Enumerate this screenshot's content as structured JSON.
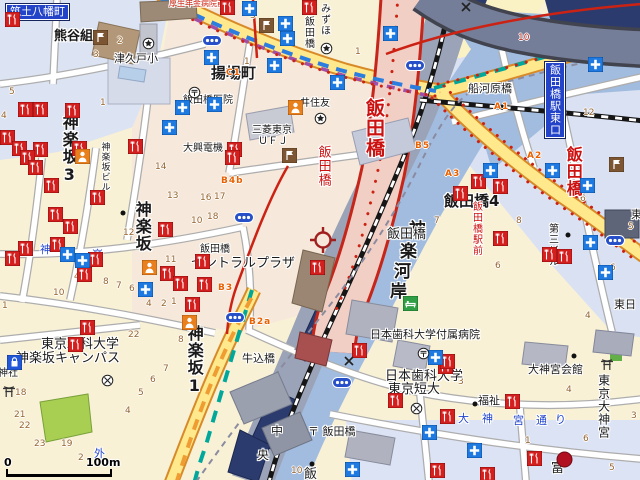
{
  "map": {
    "scale_bar": {
      "start": "0",
      "end": "100m"
    },
    "center_marker": {
      "x": 323,
      "y": 240
    },
    "palette": {
      "water": "#a2bcdf",
      "road_major": "#ffe98c",
      "road_trunk": "#f2cfc5",
      "trunk_border": "#c6251a",
      "rail_corridor": "#9aa3b7",
      "expressway": "#757e98",
      "metro_tozai": "#2b7de0",
      "metro_namboku": "#00a79b",
      "metro_yurakucho": "#ef9d32",
      "metro_oedo": "#a04fa8",
      "exit_text": "#e86000",
      "block_number": "#96642f"
    },
    "labels": [
      {
        "t": "筑土八幡町",
        "x": 6,
        "y": 4,
        "s": 11,
        "o": "h",
        "style": "plate"
      },
      {
        "t": "熊谷組",
        "x": 54,
        "y": 30,
        "s": 13,
        "o": "h",
        "b": 1
      },
      {
        "t": "津久戸小",
        "x": 114,
        "y": 53,
        "s": 11,
        "o": "h"
      },
      {
        "t": "厚生年金病院前",
        "x": 169,
        "y": 0,
        "s": 8,
        "o": "h",
        "c": "#cc2211"
      },
      {
        "t": "みずほ",
        "x": 318,
        "y": 3,
        "s": 10,
        "o": "v"
      },
      {
        "t": "飯田橋",
        "x": 302,
        "y": 16,
        "s": 10,
        "o": "v"
      },
      {
        "t": "揚場町",
        "x": 211,
        "y": 66,
        "s": 15,
        "o": "h",
        "b": 1
      },
      {
        "t": "飯田橋医院",
        "x": 183,
        "y": 96,
        "s": 10,
        "o": "h"
      },
      {
        "t": "井住友",
        "x": 300,
        "y": 99,
        "s": 10,
        "o": "h"
      },
      {
        "t": "三菱東京",
        "x": 252,
        "y": 126,
        "s": 10,
        "o": "h"
      },
      {
        "t": "ＵＦＪ",
        "x": 258,
        "y": 137,
        "s": 10,
        "o": "h"
      },
      {
        "t": "大興電機",
        "x": 183,
        "y": 144,
        "s": 10,
        "o": "h"
      },
      {
        "t": "神楽坂3",
        "x": 60,
        "y": 114,
        "s": 16,
        "o": "v",
        "b": 1
      },
      {
        "t": "神楽坂ビル",
        "x": 99,
        "y": 142,
        "s": 9,
        "o": "v"
      },
      {
        "t": "神楽坂",
        "x": 133,
        "y": 201,
        "s": 16,
        "o": "v",
        "b": 1
      },
      {
        "t": "神",
        "x": 40,
        "y": 244,
        "s": 11,
        "o": "h",
        "c": "#2244cc"
      },
      {
        "t": "楽",
        "x": 92,
        "y": 249,
        "s": 11,
        "o": "h",
        "c": "#2244cc"
      },
      {
        "t": "飯田橋",
        "x": 363,
        "y": 98,
        "s": 19,
        "o": "v",
        "b": 1,
        "c": "#cc1111"
      },
      {
        "t": "飯田橋",
        "x": 316,
        "y": 145,
        "s": 13,
        "o": "v",
        "c": "#cc1111"
      },
      {
        "t": "飯田橋",
        "x": 200,
        "y": 245,
        "s": 10,
        "o": "h"
      },
      {
        "t": "セントラルプラザ",
        "x": 191,
        "y": 257,
        "s": 13,
        "o": "h"
      },
      {
        "t": "神",
        "x": 409,
        "y": 222,
        "s": 17,
        "o": "h",
        "b": 1
      },
      {
        "t": "楽",
        "x": 400,
        "y": 244,
        "s": 17,
        "o": "h",
        "b": 1
      },
      {
        "t": "河",
        "x": 394,
        "y": 264,
        "s": 17,
        "o": "h",
        "b": 1
      },
      {
        "t": "岸",
        "x": 390,
        "y": 284,
        "s": 17,
        "o": "h",
        "b": 1
      },
      {
        "t": "飯田橋",
        "x": 387,
        "y": 228,
        "s": 13,
        "o": "h"
      },
      {
        "t": "飯田橋4",
        "x": 444,
        "y": 194,
        "s": 15,
        "o": "h",
        "b": 1
      },
      {
        "t": "飯田橋駅前",
        "x": 470,
        "y": 201,
        "s": 10,
        "o": "v",
        "c": "#cc1111"
      },
      {
        "t": "第三ビル",
        "x": 546,
        "y": 223,
        "s": 10,
        "o": "v"
      },
      {
        "t": "飯田橋",
        "x": 564,
        "y": 146,
        "s": 16,
        "o": "v",
        "b": 1,
        "c": "#cc1111"
      },
      {
        "t": "飯田橋駅東口",
        "x": 545,
        "y": 62,
        "s": 11,
        "o": "v",
        "style": "plate"
      },
      {
        "t": "船河原橋",
        "x": 468,
        "y": 83,
        "s": 11,
        "o": "h"
      },
      {
        "t": "牛込橋",
        "x": 242,
        "y": 353,
        "s": 11,
        "o": "h"
      },
      {
        "t": "外",
        "x": 94,
        "y": 448,
        "s": 11,
        "o": "h",
        "c": "#2244cc"
      },
      {
        "t": "神楽坂1",
        "x": 185,
        "y": 325,
        "s": 16,
        "o": "v",
        "b": 1
      },
      {
        "t": "東京理科大学",
        "x": 41,
        "y": 338,
        "s": 13,
        "o": "h"
      },
      {
        "t": "神楽坂キャンパス",
        "x": 16,
        "y": 352,
        "s": 13,
        "o": "h"
      },
      {
        "t": "神社",
        "x": -2,
        "y": 369,
        "s": 10,
        "o": "h"
      },
      {
        "t": "中",
        "x": 271,
        "y": 425,
        "s": 12,
        "o": "h"
      },
      {
        "t": "央",
        "x": 257,
        "y": 449,
        "s": 12,
        "o": "h"
      },
      {
        "t": "〒 飯田橋",
        "x": 308,
        "y": 426,
        "s": 11,
        "o": "h"
      },
      {
        "t": "飯",
        "x": 304,
        "y": 468,
        "s": 13,
        "o": "h"
      },
      {
        "t": "日本歯科大学付属病院",
        "x": 370,
        "y": 329,
        "s": 11,
        "o": "h"
      },
      {
        "t": "日本歯科大学",
        "x": 385,
        "y": 370,
        "s": 13,
        "o": "h"
      },
      {
        "t": "東京短大",
        "x": 388,
        "y": 383,
        "s": 13,
        "o": "h"
      },
      {
        "t": "福祉",
        "x": 478,
        "y": 395,
        "s": 11,
        "o": "h"
      },
      {
        "t": "大神宮会館",
        "x": 528,
        "y": 364,
        "s": 11,
        "o": "h"
      },
      {
        "t": "東京大神宮",
        "x": 597,
        "y": 374,
        "s": 12,
        "o": "v"
      },
      {
        "t": "大",
        "x": 458,
        "y": 413,
        "s": 11,
        "o": "h",
        "c": "#2244cc"
      },
      {
        "t": "神",
        "x": 482,
        "y": 413,
        "s": 11,
        "o": "h",
        "c": "#2244cc"
      },
      {
        "t": "宮",
        "x": 513,
        "y": 415,
        "s": 11,
        "o": "h",
        "c": "#2244cc"
      },
      {
        "t": "通",
        "x": 536,
        "y": 415,
        "s": 11,
        "o": "h",
        "c": "#2244cc"
      },
      {
        "t": "り",
        "x": 555,
        "y": 414,
        "s": 11,
        "o": "h",
        "c": "#2244cc"
      },
      {
        "t": "東日",
        "x": 614,
        "y": 299,
        "s": 11,
        "o": "h"
      },
      {
        "t": "東",
        "x": 631,
        "y": 209,
        "s": 11,
        "o": "h"
      },
      {
        "t": "富",
        "x": 551,
        "y": 462,
        "s": 13,
        "o": "h"
      }
    ],
    "exit_labels": [
      {
        "t": "C1",
        "x": 226,
        "y": 68
      },
      {
        "t": "B4b",
        "x": 221,
        "y": 176
      },
      {
        "t": "B3",
        "x": 218,
        "y": 283
      },
      {
        "t": "B2a",
        "x": 249,
        "y": 317
      },
      {
        "t": "B5",
        "x": 415,
        "y": 141
      },
      {
        "t": "A1",
        "x": 494,
        "y": 102
      },
      {
        "t": "A2",
        "x": 527,
        "y": 151
      },
      {
        "t": "A3",
        "x": 445,
        "y": 169
      }
    ],
    "block_numbers": [
      {
        "t": "3",
        "x": 93,
        "y": 50
      },
      {
        "t": "2",
        "x": 117,
        "y": 36
      },
      {
        "t": "5",
        "x": 9,
        "y": 87
      },
      {
        "t": "1",
        "x": 100,
        "y": 98
      },
      {
        "t": "4",
        "x": 1,
        "y": 111
      },
      {
        "t": "3",
        "x": 250,
        "y": 11
      },
      {
        "t": "1",
        "x": 244,
        "y": 57
      },
      {
        "t": "1",
        "x": 355,
        "y": 47
      },
      {
        "t": "1",
        "x": 283,
        "y": 152
      },
      {
        "t": "16",
        "x": 200,
        "y": 193
      },
      {
        "t": "17",
        "x": 214,
        "y": 192
      },
      {
        "t": "18",
        "x": 207,
        "y": 212
      },
      {
        "t": "14",
        "x": 155,
        "y": 162
      },
      {
        "t": "13",
        "x": 167,
        "y": 191
      },
      {
        "t": "12",
        "x": 123,
        "y": 228
      },
      {
        "t": "10",
        "x": 191,
        "y": 216
      },
      {
        "t": "11",
        "x": 165,
        "y": 255
      },
      {
        "t": "10",
        "x": 53,
        "y": 288
      },
      {
        "t": "4",
        "x": 74,
        "y": 272
      },
      {
        "t": "8",
        "x": 103,
        "y": 277
      },
      {
        "t": "7",
        "x": 116,
        "y": 281
      },
      {
        "t": "6",
        "x": 129,
        "y": 284
      },
      {
        "t": "4",
        "x": 146,
        "y": 299
      },
      {
        "t": "2",
        "x": 161,
        "y": 299
      },
      {
        "t": "1",
        "x": 171,
        "y": 297
      },
      {
        "t": "22",
        "x": 128,
        "y": 330
      },
      {
        "t": "1",
        "x": 2,
        "y": 301
      },
      {
        "t": "18",
        "x": 15,
        "y": 388
      },
      {
        "t": "21",
        "x": 14,
        "y": 410
      },
      {
        "t": "22",
        "x": 19,
        "y": 421
      },
      {
        "t": "23",
        "x": 34,
        "y": 439
      },
      {
        "t": "19",
        "x": 61,
        "y": 439
      },
      {
        "t": "2",
        "x": 78,
        "y": 453
      },
      {
        "t": "4",
        "x": 125,
        "y": 406
      },
      {
        "t": "8",
        "x": 178,
        "y": 335
      },
      {
        "t": "7",
        "x": 163,
        "y": 364
      },
      {
        "t": "6",
        "x": 150,
        "y": 375
      },
      {
        "t": "5",
        "x": 138,
        "y": 388
      },
      {
        "t": "12",
        "x": 583,
        "y": 108
      },
      {
        "t": "10",
        "x": 518,
        "y": 33,
        "c": "#c03020"
      },
      {
        "t": "7",
        "x": 434,
        "y": 216
      },
      {
        "t": "8",
        "x": 516,
        "y": 216
      },
      {
        "t": "6",
        "x": 495,
        "y": 261
      },
      {
        "t": "6",
        "x": 580,
        "y": 194
      },
      {
        "t": "6",
        "x": 610,
        "y": 263
      },
      {
        "t": "5",
        "x": 628,
        "y": 222
      },
      {
        "t": "4",
        "x": 585,
        "y": 311
      },
      {
        "t": "3",
        "x": 458,
        "y": 377
      },
      {
        "t": "3",
        "x": 631,
        "y": 411
      },
      {
        "t": "1",
        "x": 525,
        "y": 436
      },
      {
        "t": "6",
        "x": 583,
        "y": 434
      },
      {
        "t": "5",
        "x": 609,
        "y": 463
      },
      {
        "t": "4",
        "x": 566,
        "y": 385
      },
      {
        "t": "10",
        "x": 291,
        "y": 466
      },
      {
        "t": "11",
        "x": 431,
        "y": 469
      }
    ],
    "icons": [
      {
        "t": "rest",
        "x": 5,
        "y": 12
      },
      {
        "t": "rest",
        "x": 18,
        "y": 102
      },
      {
        "t": "rest",
        "x": 33,
        "y": 102
      },
      {
        "t": "rest",
        "x": 65,
        "y": 103
      },
      {
        "t": "rest",
        "x": 0,
        "y": 130
      },
      {
        "t": "rest",
        "x": 12,
        "y": 141
      },
      {
        "t": "rest",
        "x": 33,
        "y": 142
      },
      {
        "t": "rest",
        "x": 72,
        "y": 141
      },
      {
        "t": "rest",
        "x": 128,
        "y": 139
      },
      {
        "t": "rest",
        "x": 220,
        "y": 0
      },
      {
        "t": "rest",
        "x": 302,
        "y": 0
      },
      {
        "t": "rest",
        "x": 227,
        "y": 142
      },
      {
        "t": "rest",
        "x": 20,
        "y": 150
      },
      {
        "t": "rest",
        "x": 28,
        "y": 160
      },
      {
        "t": "rest",
        "x": 44,
        "y": 178
      },
      {
        "t": "rest",
        "x": 90,
        "y": 190
      },
      {
        "t": "rest",
        "x": 48,
        "y": 207
      },
      {
        "t": "rest",
        "x": 63,
        "y": 219
      },
      {
        "t": "rest",
        "x": 225,
        "y": 150
      },
      {
        "t": "rest",
        "x": 158,
        "y": 222
      },
      {
        "t": "rest",
        "x": 50,
        "y": 237
      },
      {
        "t": "rest",
        "x": 18,
        "y": 241
      },
      {
        "t": "rest",
        "x": 5,
        "y": 251
      },
      {
        "t": "rest",
        "x": 88,
        "y": 252
      },
      {
        "t": "rest",
        "x": 77,
        "y": 267
      },
      {
        "t": "rest",
        "x": 160,
        "y": 266
      },
      {
        "t": "rest",
        "x": 173,
        "y": 276
      },
      {
        "t": "rest",
        "x": 195,
        "y": 254
      },
      {
        "t": "rest",
        "x": 197,
        "y": 277
      },
      {
        "t": "rest",
        "x": 185,
        "y": 297
      },
      {
        "t": "rest",
        "x": 80,
        "y": 320
      },
      {
        "t": "rest",
        "x": 68,
        "y": 337
      },
      {
        "t": "rest",
        "x": 310,
        "y": 260
      },
      {
        "t": "rest",
        "x": 352,
        "y": 343
      },
      {
        "t": "rest",
        "x": 388,
        "y": 393
      },
      {
        "t": "rest",
        "x": 438,
        "y": 359
      },
      {
        "t": "rest",
        "x": 430,
        "y": 463
      },
      {
        "t": "rest",
        "x": 471,
        "y": 174
      },
      {
        "t": "rest",
        "x": 493,
        "y": 179
      },
      {
        "t": "rest",
        "x": 453,
        "y": 186
      },
      {
        "t": "rest",
        "x": 493,
        "y": 231
      },
      {
        "t": "rest",
        "x": 542,
        "y": 247
      },
      {
        "t": "rest",
        "x": 557,
        "y": 249
      },
      {
        "t": "rest",
        "x": 505,
        "y": 394
      },
      {
        "t": "rest",
        "x": 440,
        "y": 354
      },
      {
        "t": "rest",
        "x": 440,
        "y": 409
      },
      {
        "t": "rest",
        "x": 527,
        "y": 451
      },
      {
        "t": "rest",
        "x": 480,
        "y": 467
      },
      {
        "t": "hosp",
        "x": 204,
        "y": 50
      },
      {
        "t": "hosp",
        "x": 242,
        "y": 1
      },
      {
        "t": "hosp",
        "x": 278,
        "y": 16
      },
      {
        "t": "hosp",
        "x": 280,
        "y": 31
      },
      {
        "t": "hosp",
        "x": 267,
        "y": 58
      },
      {
        "t": "hosp",
        "x": 330,
        "y": 75
      },
      {
        "t": "hosp",
        "x": 175,
        "y": 100
      },
      {
        "t": "hosp",
        "x": 162,
        "y": 120
      },
      {
        "t": "hosp",
        "x": 207,
        "y": 97
      },
      {
        "t": "hosp",
        "x": 588,
        "y": 57
      },
      {
        "t": "hosp",
        "x": 483,
        "y": 163
      },
      {
        "t": "hosp",
        "x": 545,
        "y": 163
      },
      {
        "t": "hosp",
        "x": 580,
        "y": 178
      },
      {
        "t": "hosp",
        "x": 583,
        "y": 235
      },
      {
        "t": "hosp",
        "x": 598,
        "y": 265
      },
      {
        "t": "hosp",
        "x": 467,
        "y": 443
      },
      {
        "t": "hosp",
        "x": 428,
        "y": 350
      },
      {
        "t": "hosp",
        "x": 422,
        "y": 425
      },
      {
        "t": "hosp",
        "x": 345,
        "y": 462
      },
      {
        "t": "hosp",
        "x": 138,
        "y": 282
      },
      {
        "t": "hosp",
        "x": 60,
        "y": 247
      },
      {
        "t": "hosp",
        "x": 75,
        "y": 253
      },
      {
        "t": "hosp",
        "x": 383,
        "y": 26
      },
      {
        "t": "flag",
        "x": 93,
        "y": 30
      },
      {
        "t": "flag",
        "x": 259,
        "y": 18
      },
      {
        "t": "flag",
        "x": 282,
        "y": 148
      },
      {
        "t": "flag",
        "x": 609,
        "y": 157
      },
      {
        "t": "oval",
        "x": 202,
        "y": 35
      },
      {
        "t": "oval",
        "x": 405,
        "y": 60
      },
      {
        "t": "oval",
        "x": 234,
        "y": 212
      },
      {
        "t": "oval",
        "x": 225,
        "y": 312
      },
      {
        "t": "oval",
        "x": 332,
        "y": 377
      },
      {
        "t": "oval",
        "x": 605,
        "y": 235
      },
      {
        "t": "person",
        "x": 75,
        "y": 149
      },
      {
        "t": "person",
        "x": 142,
        "y": 260
      },
      {
        "t": "person",
        "x": 182,
        "y": 315
      },
      {
        "t": "person",
        "x": 288,
        "y": 100
      },
      {
        "t": "bank",
        "x": 142,
        "y": 37
      },
      {
        "t": "bank",
        "x": 320,
        "y": 42
      },
      {
        "t": "bank",
        "x": 314,
        "y": 112
      },
      {
        "t": "post",
        "x": 188,
        "y": 86
      },
      {
        "t": "post",
        "x": 417,
        "y": 347
      },
      {
        "t": "school",
        "x": 101,
        "y": 374
      },
      {
        "t": "school",
        "x": 410,
        "y": 402
      },
      {
        "t": "polx",
        "x": 344,
        "y": 356
      },
      {
        "t": "polx",
        "x": 461,
        "y": 2
      },
      {
        "t": "bag",
        "x": 7,
        "y": 355
      },
      {
        "t": "torii",
        "x": 600,
        "y": 358
      },
      {
        "t": "torii",
        "x": 2,
        "y": 385
      },
      {
        "t": "green",
        "x": 403,
        "y": 296
      },
      {
        "t": "reddot",
        "x": 556,
        "y": 451
      },
      {
        "t": "dot",
        "x": 120,
        "y": 210
      },
      {
        "t": "dot",
        "x": 571,
        "y": 353
      },
      {
        "t": "dot",
        "x": 472,
        "y": 401
      },
      {
        "t": "dot",
        "x": 309,
        "y": 461
      },
      {
        "t": "dot",
        "x": 565,
        "y": 232
      }
    ]
  }
}
